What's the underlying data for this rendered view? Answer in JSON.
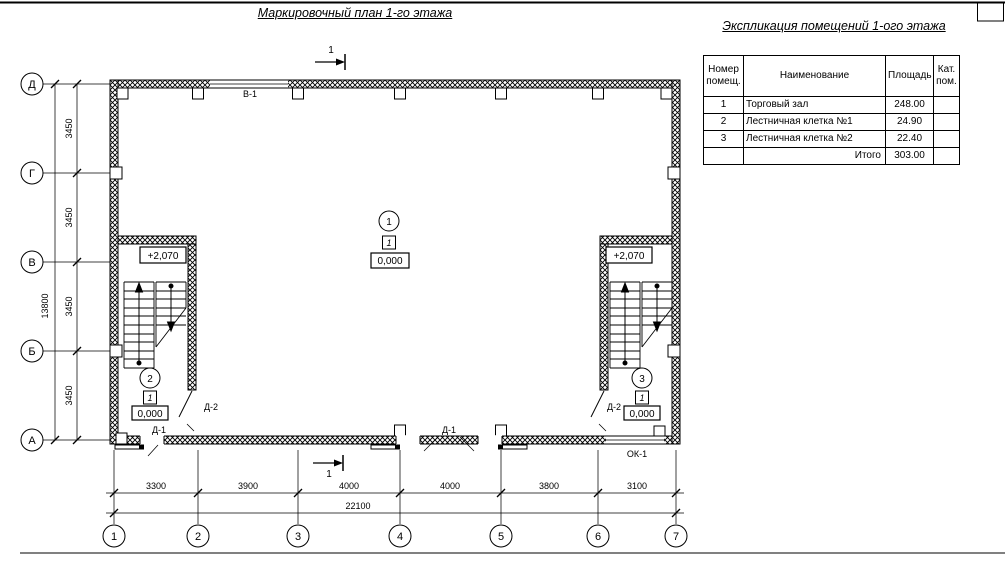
{
  "titles": {
    "plan": "Маркировочный план 1-го этажа",
    "table": "Экспликация помещений 1-ого этажа"
  },
  "table": {
    "headers": {
      "num": "Номер помещ.",
      "name": "Наименование",
      "area": "Площадь",
      "cat": "Кат. пом."
    },
    "rows": [
      {
        "num": "1",
        "name": "Торговый зал",
        "area": "248.00"
      },
      {
        "num": "2",
        "name": "Лестничная клетка №1",
        "area": "24.90"
      },
      {
        "num": "3",
        "name": "Лестничная клетка №2",
        "area": "22.40"
      }
    ],
    "total": {
      "label": "Итого",
      "area": "303.00"
    }
  },
  "axes": {
    "rows": [
      "Д",
      "Г",
      "В",
      "Б",
      "А"
    ],
    "cols": [
      "1",
      "2",
      "3",
      "4",
      "5",
      "6",
      "7"
    ]
  },
  "dims": {
    "left": {
      "segments": [
        "3450",
        "3450",
        "3450",
        "3450"
      ],
      "total": "13800"
    },
    "bottom": {
      "segments": [
        "3300",
        "3900",
        "4000",
        "4000",
        "3800",
        "3100"
      ],
      "total": "22100"
    }
  },
  "labels": {
    "window_top": "В-1",
    "window_bottom": "ОК-1",
    "door_d1": "Д-1",
    "door_d2": "Д-2",
    "elev_upper": "+2,070",
    "section": "1"
  },
  "rooms": [
    {
      "number": "1",
      "floor_type_mark": "1",
      "level": "0,000"
    },
    {
      "number": "2",
      "floor_type_mark": "1",
      "level": "0,000"
    },
    {
      "number": "3",
      "floor_type_mark": "1",
      "level": "0,000"
    }
  ]
}
